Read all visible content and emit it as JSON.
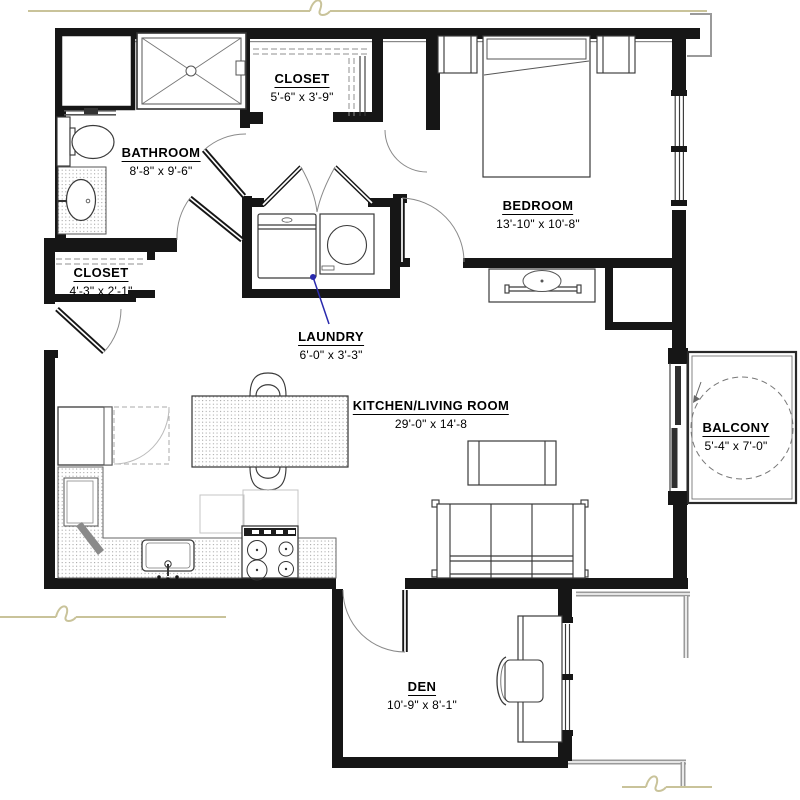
{
  "plan": {
    "title": "One-bedroom apartment floor plan",
    "rooms": [
      {
        "id": "closet_top",
        "name": "CLOSET",
        "dims": "5'-6\" x 3'-9\""
      },
      {
        "id": "bathroom",
        "name": "BATHROOM",
        "dims": "8'-8\" x 9'-6\""
      },
      {
        "id": "bedroom",
        "name": "BEDROOM",
        "dims": "13'-10\" x 10'-8\""
      },
      {
        "id": "closet_entry",
        "name": "CLOSET",
        "dims": "4'-3\" x 2'-1\""
      },
      {
        "id": "laundry",
        "name": "LAUNDRY",
        "dims": "6'-0\" x 3'-3\""
      },
      {
        "id": "kitchen_living",
        "name": "KITCHEN/LIVING ROOM",
        "dims": "29'-0\" x 14'-8"
      },
      {
        "id": "balcony",
        "name": "BALCONY",
        "dims": "5'-4\" x 7'-0\""
      },
      {
        "id": "den",
        "name": "DEN",
        "dims": "10'-9\" x 8'-1\""
      }
    ],
    "colors": {
      "wall": "#161616",
      "neighbor_wall": "#9a9a9a",
      "break_line": "#c9c39a",
      "leader": "#2a2aad",
      "background": "#ffffff"
    }
  }
}
